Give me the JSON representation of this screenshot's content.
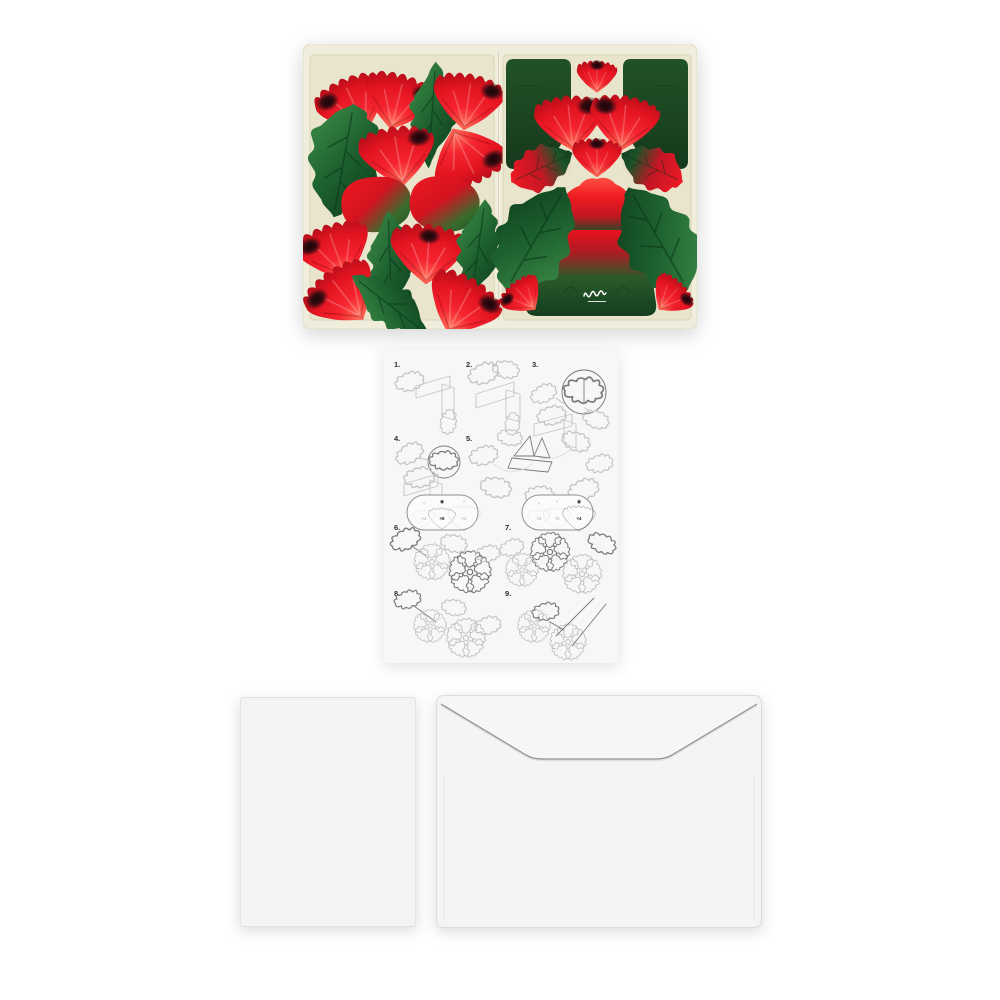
{
  "scene": {
    "background": "#ffffff"
  },
  "die_cut_sheet": {
    "panel_count": 2,
    "colors": {
      "paper": "#f0eddc",
      "panel": "#e9e5cc",
      "petal_red": "#e8131f",
      "petal_dark_red": "#a80c18",
      "petal_spot": "#20080c",
      "leaf_green": "#2e7c3a",
      "leaf_dark_green": "#0b3a1a",
      "card_green": "#1b4a24"
    }
  },
  "instruction_sheet": {
    "paper_color": "#f7f7f6",
    "steps": [
      {
        "label": "1."
      },
      {
        "label": "2."
      },
      {
        "label": "3."
      },
      {
        "label": "4."
      },
      {
        "label": "5."
      },
      {
        "label": "6."
      },
      {
        "label": "7."
      },
      {
        "label": "8."
      },
      {
        "label": "9."
      }
    ],
    "callouts": {
      "step6": {
        "items": [
          {
            "mark": "×",
            "count": "×4",
            "selected": false
          },
          {
            "mark": "◉",
            "count": "×8",
            "selected": true
          },
          {
            "mark": "×",
            "count": "×4",
            "selected": false
          }
        ]
      },
      "step7": {
        "items": [
          {
            "mark": "×",
            "count": "×4",
            "selected": false
          },
          {
            "mark": "×",
            "count": "×8",
            "selected": false
          },
          {
            "mark": "◉",
            "count": "×4",
            "selected": true
          }
        ]
      }
    }
  },
  "card": {
    "color": "#f3f3f2"
  },
  "envelope": {
    "color": "#f4f4f3"
  }
}
